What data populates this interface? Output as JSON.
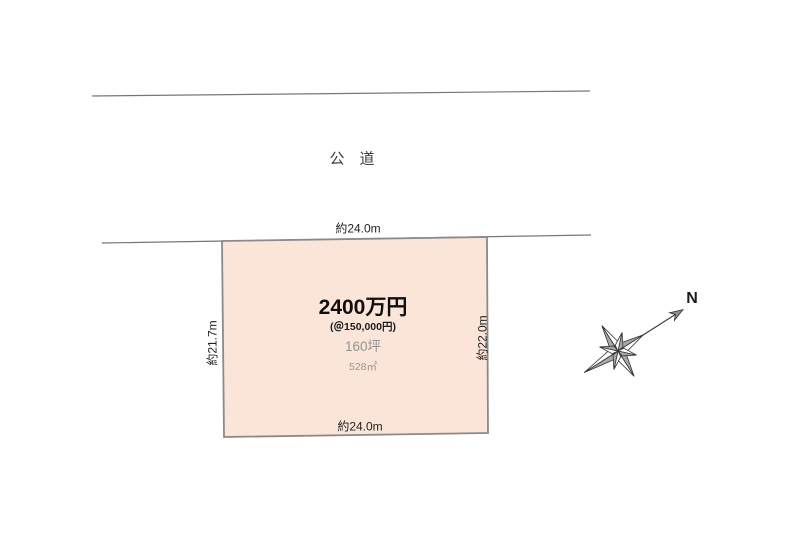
{
  "road": {
    "label": "公　道"
  },
  "plot": {
    "price": "2400万円",
    "unit_price": "(＠150,000円)",
    "area_tsubo": "160坪",
    "area_sqm": "528㎡",
    "dim_top": "約24.0m",
    "dim_bottom": "約24.0m",
    "dim_left": "約21.7m",
    "dim_right": "約22.0m",
    "fill_color": "#fae5d8",
    "border_color": "#8a8a8a"
  },
  "compass": {
    "north_label": "N"
  }
}
